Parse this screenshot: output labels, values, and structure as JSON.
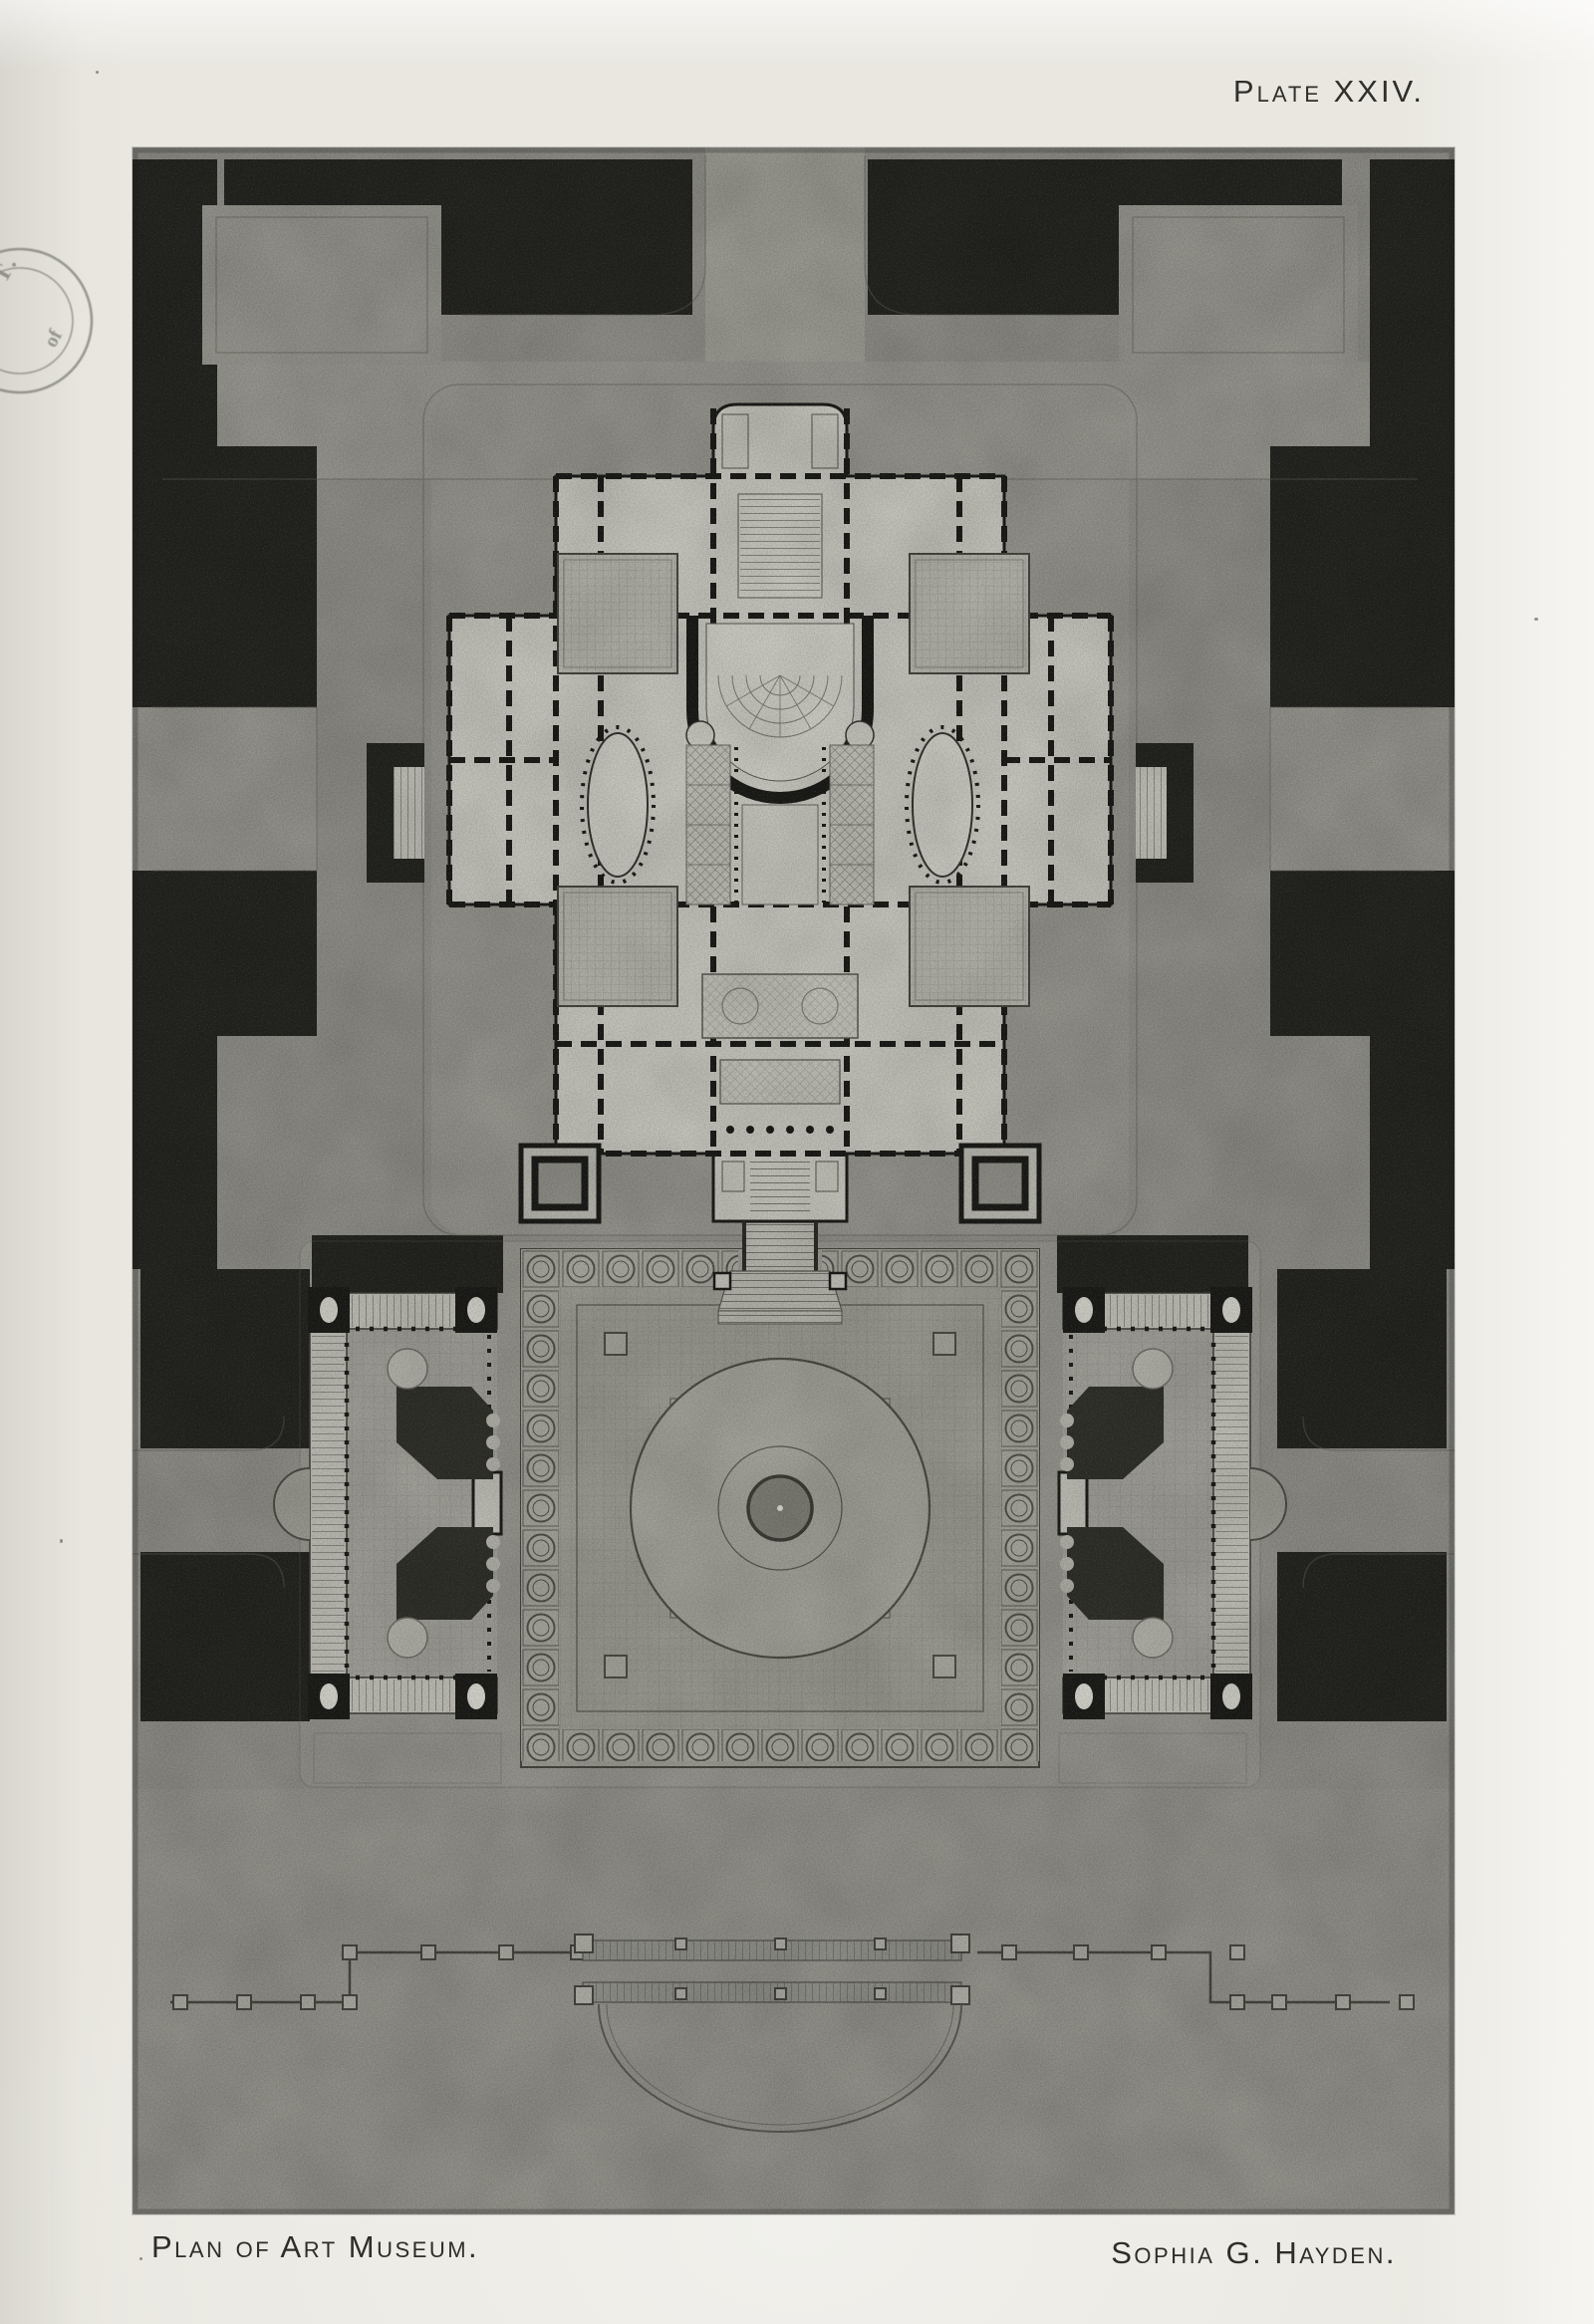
{
  "page": {
    "plate_label": "Plate XXIV.",
    "captions": {
      "title": "Plan of Art Museum.",
      "architect": "Sophia G. Hayden."
    },
    "stamp": {
      "institution": "M. I. T.",
      "word": "of"
    },
    "colors": {
      "paper": "#e9e7e0",
      "plate_gray": "#8f8e88",
      "dark_foliage": "#23231f",
      "building_light": "#c8c7bf",
      "ink": "#2f2f2c"
    }
  },
  "figure": {
    "type": "architectural-plan",
    "plate_number": "XXIV",
    "title": "Plan of Art Museum",
    "architect": "Sophia G. Hayden"
  }
}
